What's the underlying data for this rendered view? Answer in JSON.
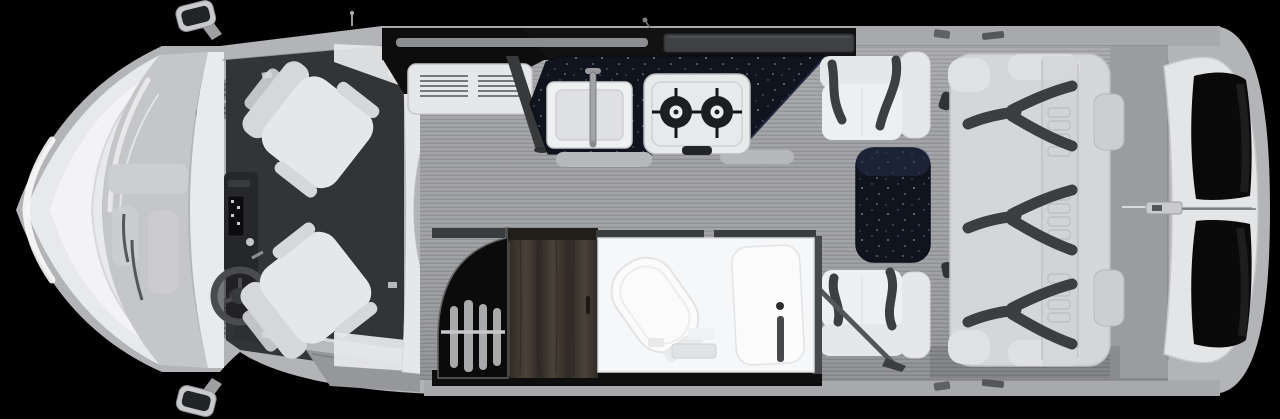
{
  "scene": {
    "subject": "rv-class-b-motorhome-floor-plan-top-view",
    "orientation": "front-left-rear-right",
    "areas": [
      "cab",
      "galley",
      "dinette",
      "wardrobe",
      "bathroom",
      "rear-sofa",
      "rear-doors"
    ],
    "fixtures": [
      "driver-seat",
      "passenger-seat",
      "steering-wheel",
      "sink",
      "faucet",
      "two-burner-stove",
      "dinette-table",
      "toilet",
      "shower",
      "clothes-rod",
      "seatbelts",
      "side-mirrors",
      "entry-step"
    ]
  },
  "colors": {
    "bg": "#000000",
    "shell": "#b3b4b8",
    "shellEdge": "#8f9094",
    "shellLight": "#c9cacd",
    "hood": "#e8e9eb",
    "hoodBright": "#f4f4f6",
    "glass": "#c5c6c9",
    "glassPanel": "#cdced1",
    "cowl": "#e9eaec",
    "cabFloor": "#333436",
    "dash": "#26272a",
    "screen": "#0c0c0e",
    "wheel": "#4a4b4e",
    "seat": "#d6d7d9",
    "seatShade": "#c2c3c6",
    "seatLight": "#e6e7e9",
    "seatWhite": "#eeeff1",
    "belt": "#3d3e40",
    "floorA": "#a3a4a8",
    "floorB": "#909195",
    "floorRear": "#9b9c9f",
    "wall": "#a8a9ad",
    "wallSeam": "#8c8d90",
    "cabinetBlack": "#121213",
    "slotLight": "#9a9b9f",
    "windowSlot": "#3f4043",
    "counter": "#10141f",
    "counterTop": "#27304a",
    "chrome": "#c7c8ca",
    "steel": "#9b9c9f",
    "appliance": "#e6e7e9",
    "slat": "#77787b",
    "sink": "#eff0f2",
    "basin": "#dfe0e3",
    "stove": "#e8e9eb",
    "burner": "#1d1e20",
    "table": "#141827",
    "sofa": "#d5d6d8",
    "sofaEdge": "#e0e1e3",
    "stitch": "#bcbdc0",
    "bath": "#f6f7f8",
    "bathWall": "#3b3c3e",
    "fixture": "#fbfbfc",
    "fixtureLine": "#e2e3e5",
    "showerDark": "#47484b",
    "wardrobe": "#0b0b0c",
    "hanger": "#b9babc",
    "wood1": "#4a4239",
    "wood2": "#2e2a24",
    "woodRail": "#211e1a",
    "doorPanel": "#e4e5e7",
    "glassBlack": "#0a0a0b",
    "latch": "#c9cacc",
    "step": "#96979b",
    "stepLight": "#b9babd",
    "black": "#0e0e0f"
  }
}
